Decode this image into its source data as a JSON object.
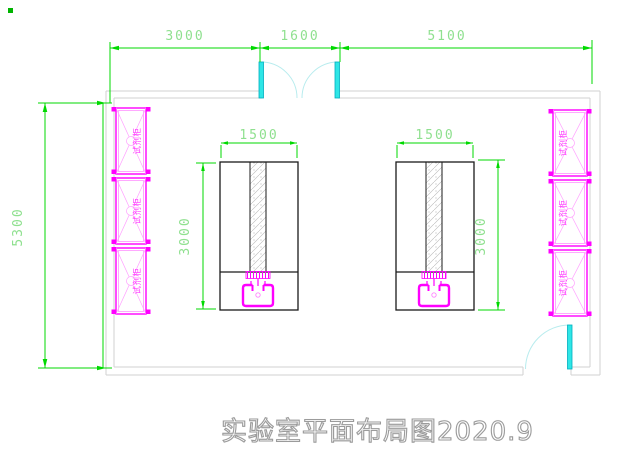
{
  "title": "实验室平面布局图2020.9",
  "dimensions": {
    "top": [
      {
        "label": "3000"
      },
      {
        "label": "1600"
      },
      {
        "label": "5100"
      }
    ],
    "left_wall": "5300",
    "bench_left": {
      "width": "1500",
      "depth": "3000"
    },
    "bench_right": {
      "width": "1500",
      "depth": "3000"
    }
  },
  "cabinets": {
    "label": "试剂柜",
    "left_count": 3,
    "right_count": 3
  },
  "colors": {
    "dimension_green": "#00d900",
    "dimension_text_green": "#8fe08f",
    "cabinet_magenta": "#ff00ff",
    "door_cyan": "#2ee6e6",
    "door_arc_cyan": "#b8ecee",
    "wall_gray": "#d2d2d2",
    "bench_black": "#1a1a1a",
    "title_gray": "#9b9b9b"
  }
}
